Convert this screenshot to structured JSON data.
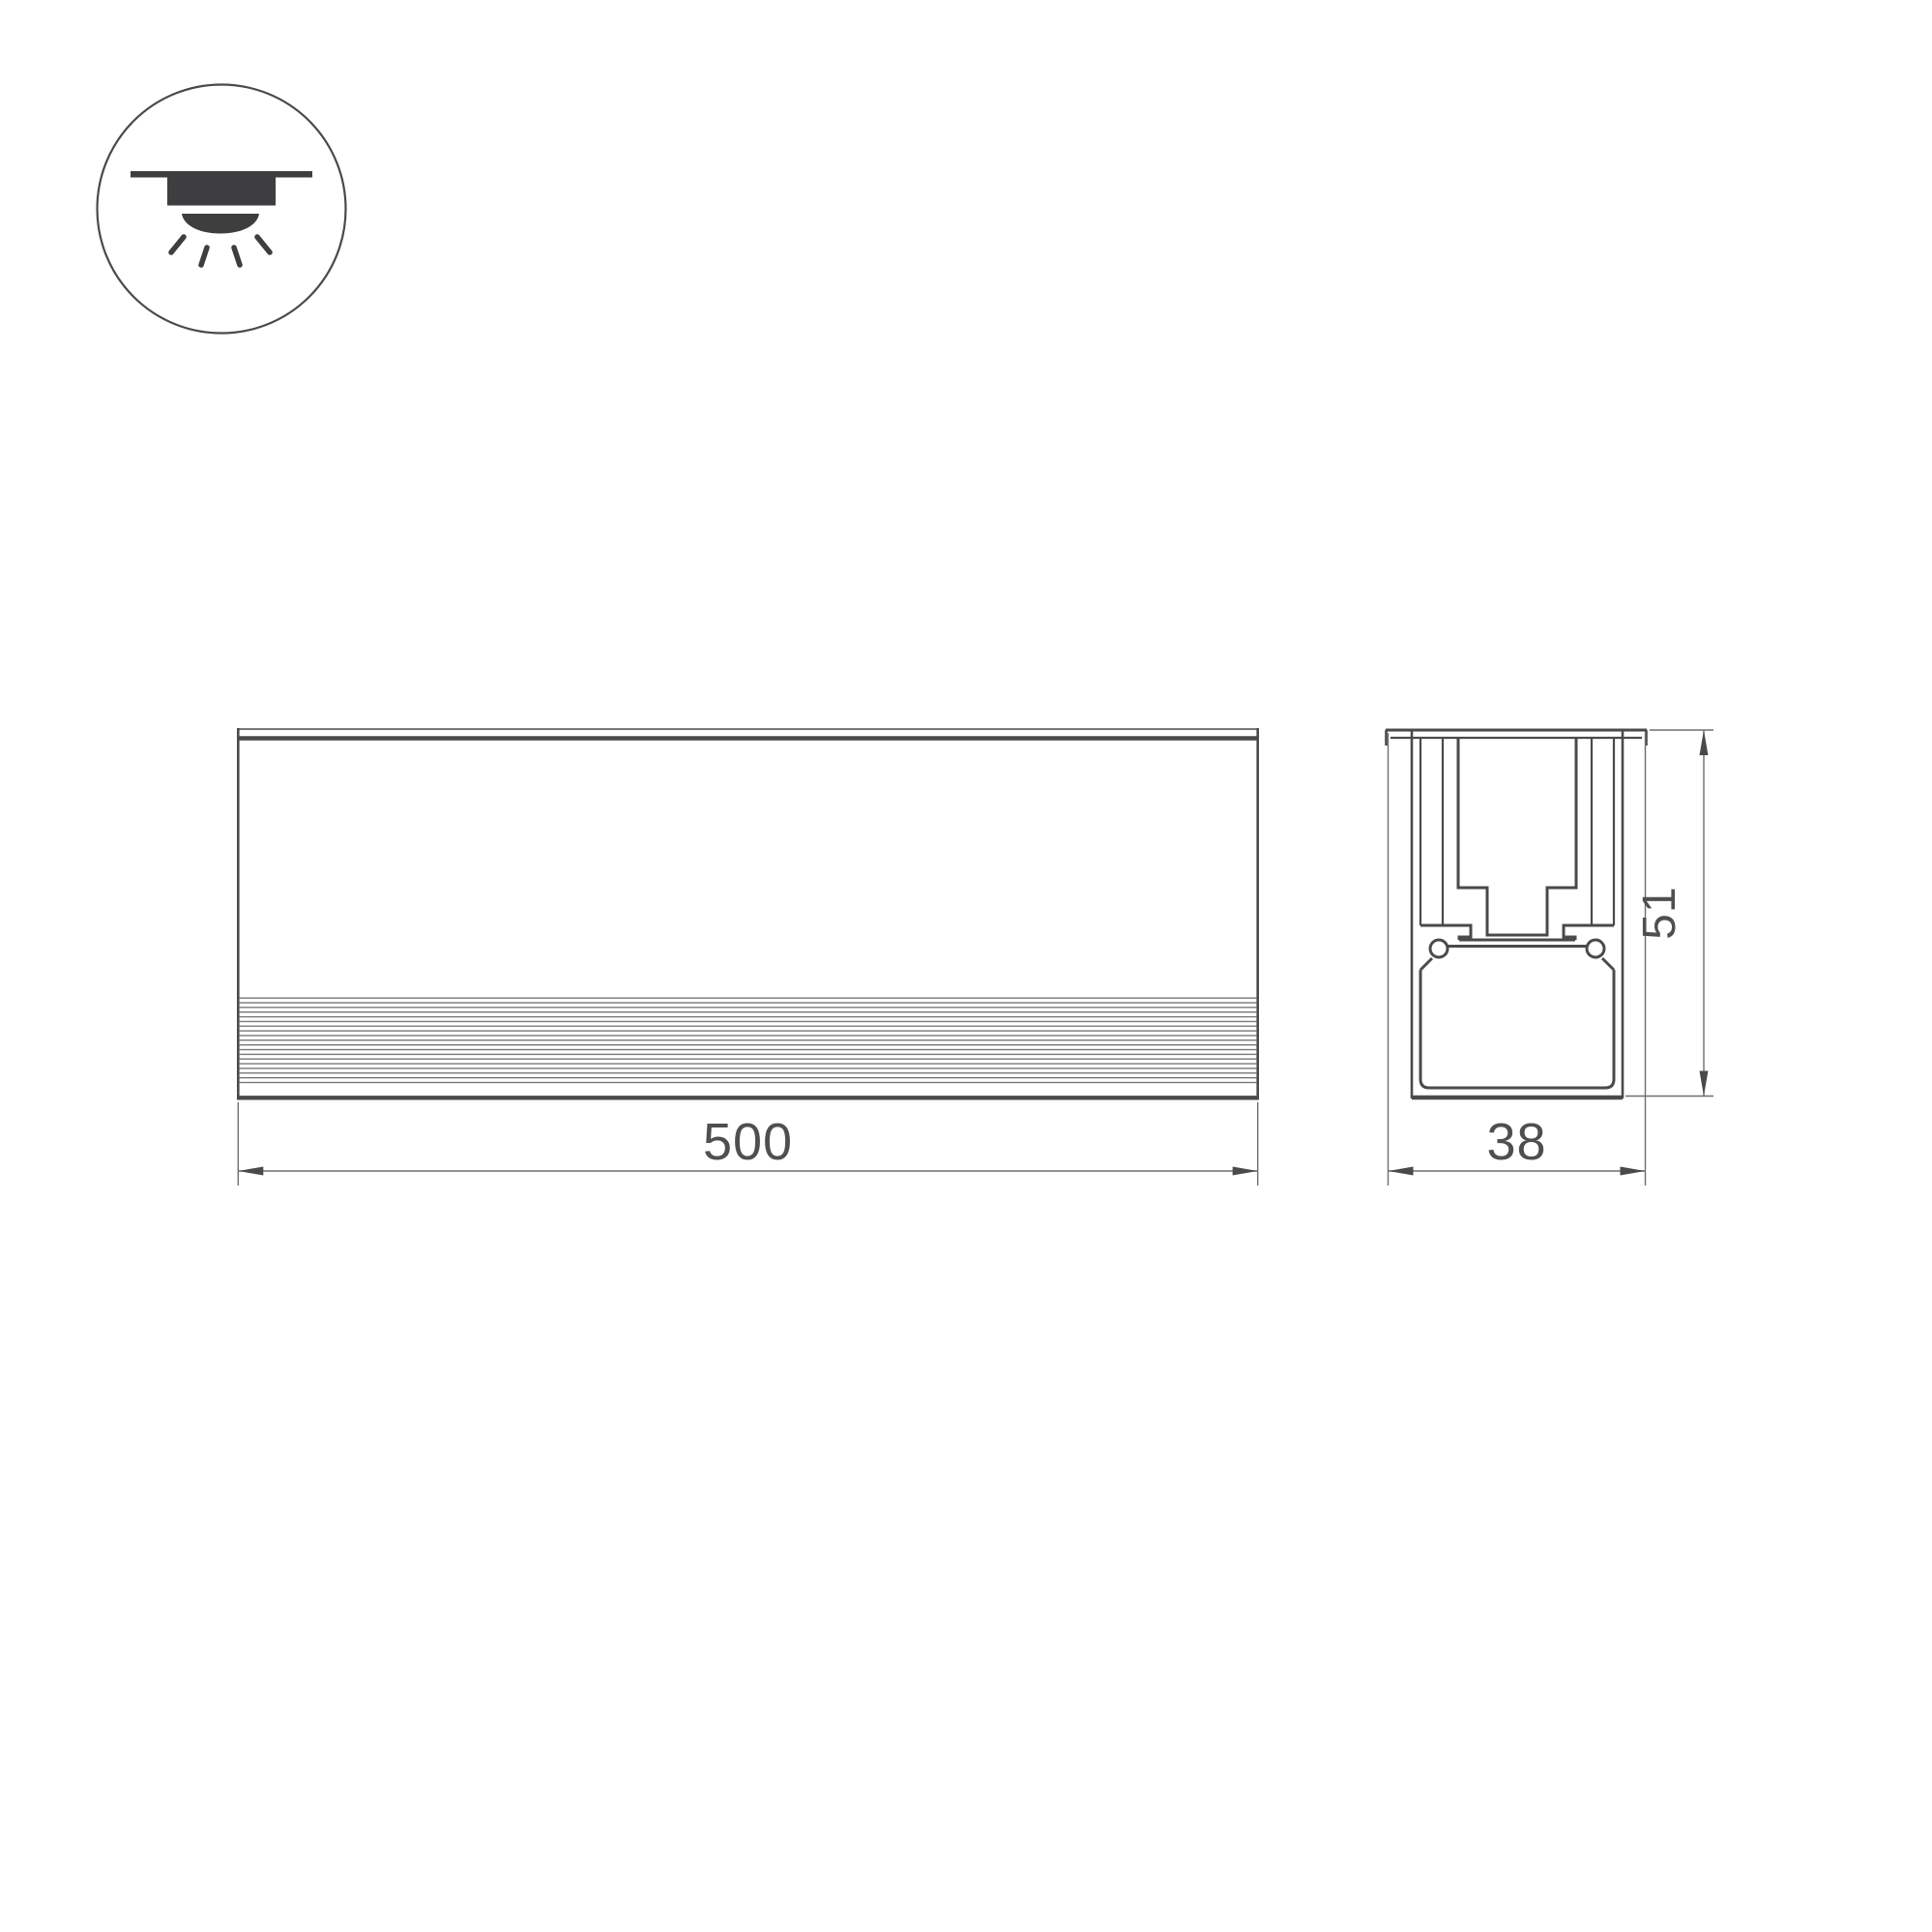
{
  "drawing": {
    "type": "luminaire-dimension-drawing",
    "icon": {
      "name": "recessed-downlight-icon"
    },
    "front_view": {
      "length_label": "500"
    },
    "section_view": {
      "width_label": "38",
      "height_label": "51"
    }
  },
  "colors": {
    "background": "#ffffff",
    "stroke_main": "#4a4a4a",
    "stroke_thin": "#6e6e6e",
    "icon_fill": "#3e3e40",
    "text_color": "#4f4f4f"
  }
}
